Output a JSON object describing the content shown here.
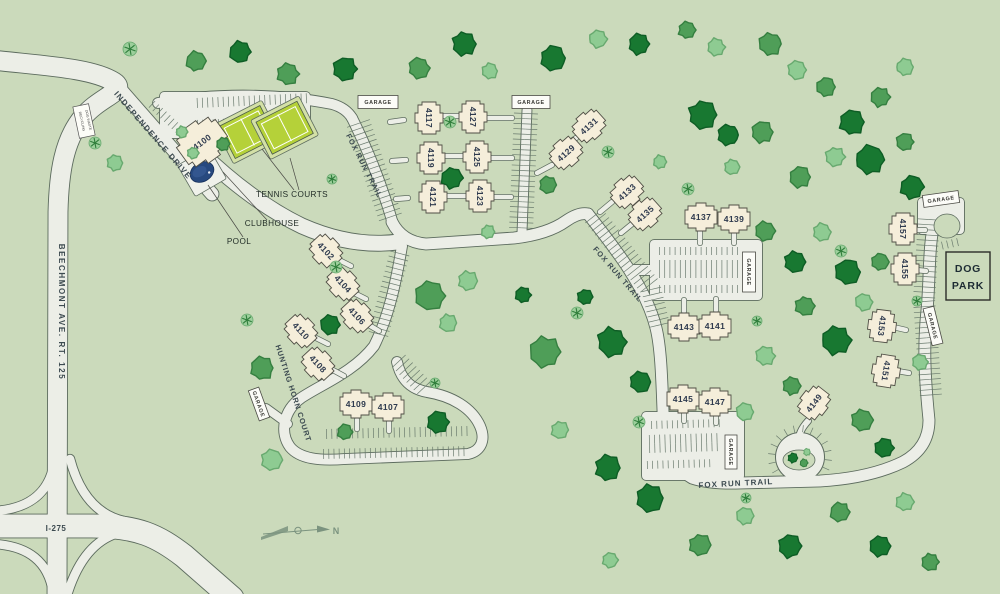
{
  "map": {
    "colors": {
      "background": "#cbdabb",
      "road_fill": "#eceee7",
      "road_casing": "#5c6b5e",
      "building_fill": "#f5eeda",
      "building_stroke": "#504f46",
      "building_label": "#2e3a4e",
      "street_label": "#3c4a50",
      "tick": "#66776a",
      "garage_fill": "#fcfcf8",
      "garage_stroke": "#4a4a44",
      "garage_label": "#3a3a35",
      "tennis_pad": "#d3e0a6",
      "tennis_court": "#b5d139",
      "pool_water": "#27497f",
      "pool_pad": "#eff1ea",
      "tree_dark": "#187831",
      "tree_dark_edge": "#0e5d25",
      "tree_mid": "#4f9e58",
      "tree_mid_edge": "#357f40",
      "tree_light": "#8ecb92",
      "tree_light_edge": "#68a96f",
      "shrub_fill": "#9ccf9b",
      "shrub_star": "#2e7d3a",
      "compass": "#7b937f",
      "leader": "#4a4a45",
      "amenity_label": "#1f2a24",
      "dogpark_label": "#1d2b33"
    },
    "streets": [
      {
        "name": "BEECHMONT AVE. RT. 125",
        "x": 59,
        "y": 312,
        "rot": 90,
        "size": 8,
        "ls": 1.6
      },
      {
        "name": "I-275",
        "x": 56,
        "y": 531,
        "rot": 0,
        "size": 8,
        "ls": 0.5
      },
      {
        "name": "INDEPENDENCE DRIVE",
        "x": 151,
        "y": 137,
        "rot": 49,
        "size": 8,
        "ls": 1.3
      },
      {
        "name": "FOX RUN TRAIL",
        "x": 362,
        "y": 167,
        "rot": 63,
        "size": 7.5,
        "ls": 1
      },
      {
        "name": "FOX RUN TRAIL",
        "x": 616,
        "y": 276,
        "rot": 49,
        "size": 7.5,
        "ls": 1
      },
      {
        "name": "FOX RUN TRAIL",
        "x": 736,
        "y": 486,
        "rot": -3,
        "size": 8,
        "ls": 1
      },
      {
        "name": "HUNTING HORN COURT",
        "x": 291,
        "y": 394,
        "rot": 72,
        "size": 7.5,
        "ls": 0.8
      }
    ],
    "buildings": [
      {
        "n": "4100",
        "x": 202,
        "y": 142,
        "r": -36,
        "s": 1.5
      },
      {
        "n": "4117",
        "x": 429,
        "y": 118,
        "r": 90
      },
      {
        "n": "4119",
        "x": 431,
        "y": 158,
        "r": 90
      },
      {
        "n": "4121",
        "x": 433,
        "y": 197,
        "r": 90
      },
      {
        "n": "4127",
        "x": 473,
        "y": 117,
        "r": 90
      },
      {
        "n": "4125",
        "x": 477,
        "y": 157,
        "r": 90
      },
      {
        "n": "4123",
        "x": 480,
        "y": 196,
        "r": 90
      },
      {
        "n": "4129",
        "x": 566,
        "y": 153,
        "r": -42
      },
      {
        "n": "4131",
        "x": 589,
        "y": 126,
        "r": -42
      },
      {
        "n": "4133",
        "x": 627,
        "y": 192,
        "r": -42
      },
      {
        "n": "4135",
        "x": 645,
        "y": 214,
        "r": -42
      },
      {
        "n": "4137",
        "x": 701,
        "y": 217,
        "r": 0
      },
      {
        "n": "4139",
        "x": 734,
        "y": 219,
        "r": 0
      },
      {
        "n": "4143",
        "x": 684,
        "y": 327,
        "r": 0
      },
      {
        "n": "4141",
        "x": 715,
        "y": 326,
        "r": 0
      },
      {
        "n": "4145",
        "x": 683,
        "y": 399,
        "r": 0
      },
      {
        "n": "4147",
        "x": 715,
        "y": 402,
        "r": 0
      },
      {
        "n": "4149",
        "x": 814,
        "y": 403,
        "r": -52
      },
      {
        "n": "4102",
        "x": 326,
        "y": 251,
        "r": 47
      },
      {
        "n": "4104",
        "x": 343,
        "y": 284,
        "r": 47
      },
      {
        "n": "4106",
        "x": 357,
        "y": 316,
        "r": 47
      },
      {
        "n": "4110",
        "x": 301,
        "y": 331,
        "r": 47
      },
      {
        "n": "4108",
        "x": 318,
        "y": 364,
        "r": 47
      },
      {
        "n": "4109",
        "x": 356,
        "y": 404,
        "r": 0
      },
      {
        "n": "4107",
        "x": 388,
        "y": 407,
        "r": 0
      },
      {
        "n": "4153",
        "x": 882,
        "y": 326,
        "r": 97
      },
      {
        "n": "4151",
        "x": 886,
        "y": 371,
        "r": 99
      },
      {
        "n": "4157",
        "x": 903,
        "y": 229,
        "r": 90
      },
      {
        "n": "4155",
        "x": 905,
        "y": 269,
        "r": 90
      }
    ],
    "garages": [
      {
        "label": "GARAGE",
        "x": 378,
        "y": 102,
        "rot": 0,
        "w": 40,
        "h": 13
      },
      {
        "label": "GARAGE",
        "x": 531,
        "y": 102,
        "rot": 0,
        "w": 38,
        "h": 13
      },
      {
        "label": "GARAGE",
        "x": 749,
        "y": 272,
        "rot": 90,
        "w": 40,
        "h": 13
      },
      {
        "label": "GARAGE",
        "x": 731,
        "y": 452,
        "rot": 90,
        "w": 34,
        "h": 12
      },
      {
        "label": "GARAGE",
        "x": 941,
        "y": 199,
        "rot": -8,
        "w": 36,
        "h": 12
      },
      {
        "label": "GARAGE",
        "x": 933,
        "y": 326,
        "rot": 76,
        "w": 38,
        "h": 11
      },
      {
        "label": "GARAGE",
        "x": 259,
        "y": 404,
        "rot": 70,
        "w": 32,
        "h": 11
      }
    ],
    "amenities": {
      "tennis": {
        "label": "TENNIS COURTS",
        "label_x": 292,
        "label_y": 197,
        "rot": -27,
        "cx": 265,
        "cy": 131,
        "courts": [
          {
            "x": 226,
            "y": 106,
            "w": 46,
            "h": 36
          },
          {
            "x": 261,
            "y": 119,
            "w": 46,
            "h": 36
          }
        ]
      },
      "clubhouse": {
        "label": "CLUBHOUSE",
        "label_x": 272,
        "label_y": 226
      },
      "pool": {
        "label": "POOL",
        "label_x": 239,
        "label_y": 244,
        "cx": 202,
        "cy": 172,
        "rot": -30
      },
      "dog_park": {
        "line1": "DOG",
        "line2": "PARK",
        "x": 946,
        "y": 252,
        "w": 44,
        "h": 48
      }
    },
    "leaders": [
      [
        294,
        190,
        262,
        149
      ],
      [
        299,
        190,
        290,
        158
      ],
      [
        267,
        220,
        223,
        172
      ],
      [
        243,
        237,
        208,
        185
      ]
    ],
    "sign": {
      "line1": "RECYCLING",
      "line2": "DOG WASTE",
      "cx": 84,
      "cy": 121,
      "rot": -12,
      "w": 16,
      "h": 32
    },
    "compass": {
      "label": "N",
      "x": 336,
      "y": 534
    },
    "roads": [
      {
        "d": "M -8 60 C 45 66 92 68 114 82 C 128 91 99 97 83 117 C 64 140 59 172 58 212 L 57 594",
        "w": 19
      },
      {
        "d": "M -8 526 L 92 526 C 138 526 158 536 184 556 L 232 598",
        "w": 23
      },
      {
        "d": "M 54 464 Q 46 508 -6 511",
        "w": 8.5
      },
      {
        "d": "M 70 459 Q 84 512 124 521",
        "w": 8.5
      },
      {
        "d": "M -6 544 Q 46 547 53 592",
        "w": 8.5
      },
      {
        "d": "M 118 533 Q 84 543 68 592",
        "w": 8.5
      },
      {
        "d": "M 113 81 L 212 194",
        "w": 13
      },
      {
        "d": "M 198 150 Q 252 202 302 226 Q 352 248 398 242",
        "w": 15
      },
      {
        "d": "M 158 103 C 220 92 282 94 332 104 Q 346 108 352 118",
        "w": 10
      },
      {
        "d": "M 352 118 C 368 150 382 185 393 224",
        "w": 10
      },
      {
        "d": "M 527 110 L 522 232",
        "w": 9
      },
      {
        "d": "M 392 222 Q 402 242 426 244 L 514 238 Q 548 234 566 221 Q 579 212 588 214",
        "w": 11
      },
      {
        "d": "M 588 214 C 618 252 646 288 656 328 C 662 352 662 394 664 434",
        "w": 11
      },
      {
        "d": "M 630 270 L 658 270",
        "w": 10
      },
      {
        "d": "M 664 434 Q 666 462 692 478 Q 710 484 740 483 L 820 481 Q 870 478 903 462 Q 929 448 929 420 C 925 380 923 348 927 310 C 930 280 928 246 935 218 Q 939 204 946 201",
        "w": 11
      },
      {
        "d": "M 402 246 C 395 288 388 318 374 346 C 354 372 322 384 301 398 C 284 410 279 432 290 447 C 300 459 320 461 345 459 L 468 454 C 481 451 486 440 480 426 C 472 408 452 396 427 392 C 411 389 401 380 397 362",
        "w": 10
      },
      {
        "d": "M 288 424 L 266 408",
        "w": 8
      },
      {
        "d": "M 808 421 Q 798 432 799 441",
        "w": 6
      }
    ],
    "lots": [
      [
        160,
        92,
        150,
        46
      ],
      [
        650,
        240,
        112,
        60
      ],
      [
        642,
        412,
        102,
        68
      ],
      [
        918,
        198,
        46,
        36
      ]
    ],
    "culdesac": {
      "cx": 800,
      "cy": 457,
      "r": 24,
      "island_rx": 16,
      "island_ry": 10
    },
    "east_island": {
      "cx": 947,
      "cy": 226,
      "rx": 13,
      "ry": 12
    },
    "parking": [
      [
        196,
        108,
        312,
        103,
        10,
        1
      ],
      [
        196,
        120,
        312,
        115,
        10,
        -1
      ],
      [
        154,
        100,
        184,
        128,
        9,
        -1
      ],
      [
        358,
        122,
        392,
        222,
        12,
        2
      ],
      [
        526,
        112,
        521,
        230,
        12,
        2
      ],
      [
        400,
        252,
        378,
        336,
        10,
        2
      ],
      [
        398,
        360,
        426,
        390,
        9,
        2
      ],
      [
        325,
        429,
        468,
        426,
        10,
        -1
      ],
      [
        322,
        449,
        470,
        446,
        10,
        -1
      ],
      [
        593,
        215,
        651,
        288,
        11,
        2
      ],
      [
        651,
        288,
        661,
        330,
        10,
        2
      ],
      [
        658,
        247,
        742,
        247,
        8,
        -1
      ],
      [
        658,
        269,
        746,
        269,
        9,
        2
      ],
      [
        658,
        293,
        740,
        293,
        8,
        1
      ],
      [
        650,
        421,
        722,
        419,
        8,
        -1
      ],
      [
        648,
        444,
        720,
        442,
        9,
        2
      ],
      [
        646,
        469,
        716,
        467,
        8,
        1
      ],
      [
        929,
        218,
        924,
        300,
        11,
        2
      ],
      [
        924,
        300,
        931,
        396,
        11,
        2
      ],
      [
        940,
        242,
        962,
        237,
        8,
        -1
      ]
    ],
    "stems": [
      [
        441,
        116,
        463,
        116
      ],
      [
        444,
        156,
        465,
        156
      ],
      [
        447,
        196,
        468,
        196
      ],
      [
        404,
        120,
        390,
        122
      ],
      [
        406,
        160,
        392,
        161
      ],
      [
        408,
        198,
        396,
        199
      ],
      [
        487,
        118,
        512,
        118
      ],
      [
        489,
        158,
        512,
        158
      ],
      [
        492,
        197,
        511,
        197
      ],
      [
        552,
        165,
        537,
        173
      ],
      [
        576,
        138,
        561,
        148
      ],
      [
        612,
        202,
        600,
        212
      ],
      [
        632,
        224,
        621,
        233
      ],
      [
        700,
        231,
        700,
        243
      ],
      [
        734,
        233,
        734,
        243
      ],
      [
        684,
        311,
        684,
        300
      ],
      [
        716,
        310,
        716,
        299
      ],
      [
        684,
        413,
        684,
        421
      ],
      [
        716,
        416,
        716,
        423
      ],
      [
        357,
        420,
        357,
        429
      ],
      [
        389,
        422,
        389,
        431
      ],
      [
        337,
        259,
        351,
        266
      ],
      [
        352,
        292,
        366,
        299
      ],
      [
        367,
        324,
        379,
        331
      ],
      [
        314,
        337,
        328,
        344
      ],
      [
        331,
        369,
        344,
        376
      ],
      [
        914,
        230,
        925,
        230
      ],
      [
        916,
        270,
        926,
        271
      ],
      [
        893,
        327,
        906,
        330
      ],
      [
        897,
        371,
        909,
        373
      ]
    ],
    "trees": {
      "d": [
        [
          240,
          52,
          11
        ],
        [
          345,
          69,
          12
        ],
        [
          464,
          44,
          12
        ],
        [
          553,
          58,
          13
        ],
        [
          639,
          44,
          11
        ],
        [
          703,
          115,
          15
        ],
        [
          728,
          135,
          11
        ],
        [
          852,
          122,
          13
        ],
        [
          870,
          160,
          15
        ],
        [
          912,
          187,
          12
        ],
        [
          452,
          178,
          11
        ],
        [
          523,
          295,
          8
        ],
        [
          330,
          325,
          10
        ],
        [
          438,
          422,
          11
        ],
        [
          612,
          342,
          15
        ],
        [
          640,
          382,
          11
        ],
        [
          608,
          468,
          13
        ],
        [
          650,
          498,
          14
        ],
        [
          795,
          262,
          11
        ],
        [
          848,
          272,
          13
        ],
        [
          836,
          340,
          15
        ],
        [
          884,
          448,
          10
        ],
        [
          790,
          546,
          12
        ],
        [
          880,
          546,
          11
        ],
        [
          585,
          297,
          8
        ]
      ],
      "m": [
        [
          196,
          61,
          10
        ],
        [
          288,
          74,
          11
        ],
        [
          419,
          68,
          11
        ],
        [
          770,
          44,
          12
        ],
        [
          687,
          30,
          9
        ],
        [
          826,
          87,
          10
        ],
        [
          880,
          97,
          10
        ],
        [
          905,
          142,
          9
        ],
        [
          762,
          132,
          11
        ],
        [
          800,
          177,
          11
        ],
        [
          545,
          352,
          16
        ],
        [
          430,
          296,
          15
        ],
        [
          765,
          231,
          10
        ],
        [
          805,
          306,
          10
        ],
        [
          880,
          262,
          9
        ],
        [
          792,
          386,
          9
        ],
        [
          862,
          420,
          11
        ],
        [
          700,
          545,
          11
        ],
        [
          840,
          512,
          10
        ],
        [
          930,
          562,
          9
        ],
        [
          548,
          185,
          9
        ],
        [
          262,
          368,
          12
        ],
        [
          223,
          144,
          7
        ],
        [
          345,
          432,
          8
        ]
      ],
      "l": [
        [
          490,
          71,
          8
        ],
        [
          598,
          39,
          9
        ],
        [
          716,
          47,
          9
        ],
        [
          797,
          70,
          10
        ],
        [
          905,
          67,
          9
        ],
        [
          835,
          157,
          10
        ],
        [
          732,
          167,
          8
        ],
        [
          468,
          281,
          10
        ],
        [
          448,
          323,
          9
        ],
        [
          560,
          430,
          9
        ],
        [
          272,
          460,
          11
        ],
        [
          115,
          163,
          8
        ],
        [
          822,
          232,
          9
        ],
        [
          864,
          302,
          9
        ],
        [
          765,
          356,
          10
        ],
        [
          745,
          412,
          9
        ],
        [
          920,
          362,
          8
        ],
        [
          745,
          516,
          9
        ],
        [
          905,
          502,
          9
        ],
        [
          610,
          560,
          8
        ],
        [
          660,
          162,
          7
        ],
        [
          182,
          132,
          6
        ],
        [
          193,
          153,
          6
        ],
        [
          488,
          232,
          7
        ]
      ],
      "sb": [
        [
          130,
          49,
          7
        ],
        [
          95,
          143,
          6
        ],
        [
          336,
          267,
          6
        ],
        [
          247,
          320,
          6
        ],
        [
          450,
          122,
          6
        ],
        [
          332,
          179,
          5
        ],
        [
          608,
          152,
          6
        ],
        [
          688,
          189,
          6
        ],
        [
          577,
          313,
          6
        ],
        [
          639,
          422,
          6
        ],
        [
          746,
          498,
          5
        ],
        [
          841,
          251,
          6
        ],
        [
          757,
          321,
          5
        ],
        [
          917,
          301,
          5
        ],
        [
          435,
          383,
          5
        ]
      ]
    },
    "island_bushes": [
      [
        793,
        458,
        5,
        "d"
      ],
      [
        804,
        463,
        4,
        "m"
      ],
      [
        807,
        452,
        3.5,
        "l"
      ]
    ]
  }
}
